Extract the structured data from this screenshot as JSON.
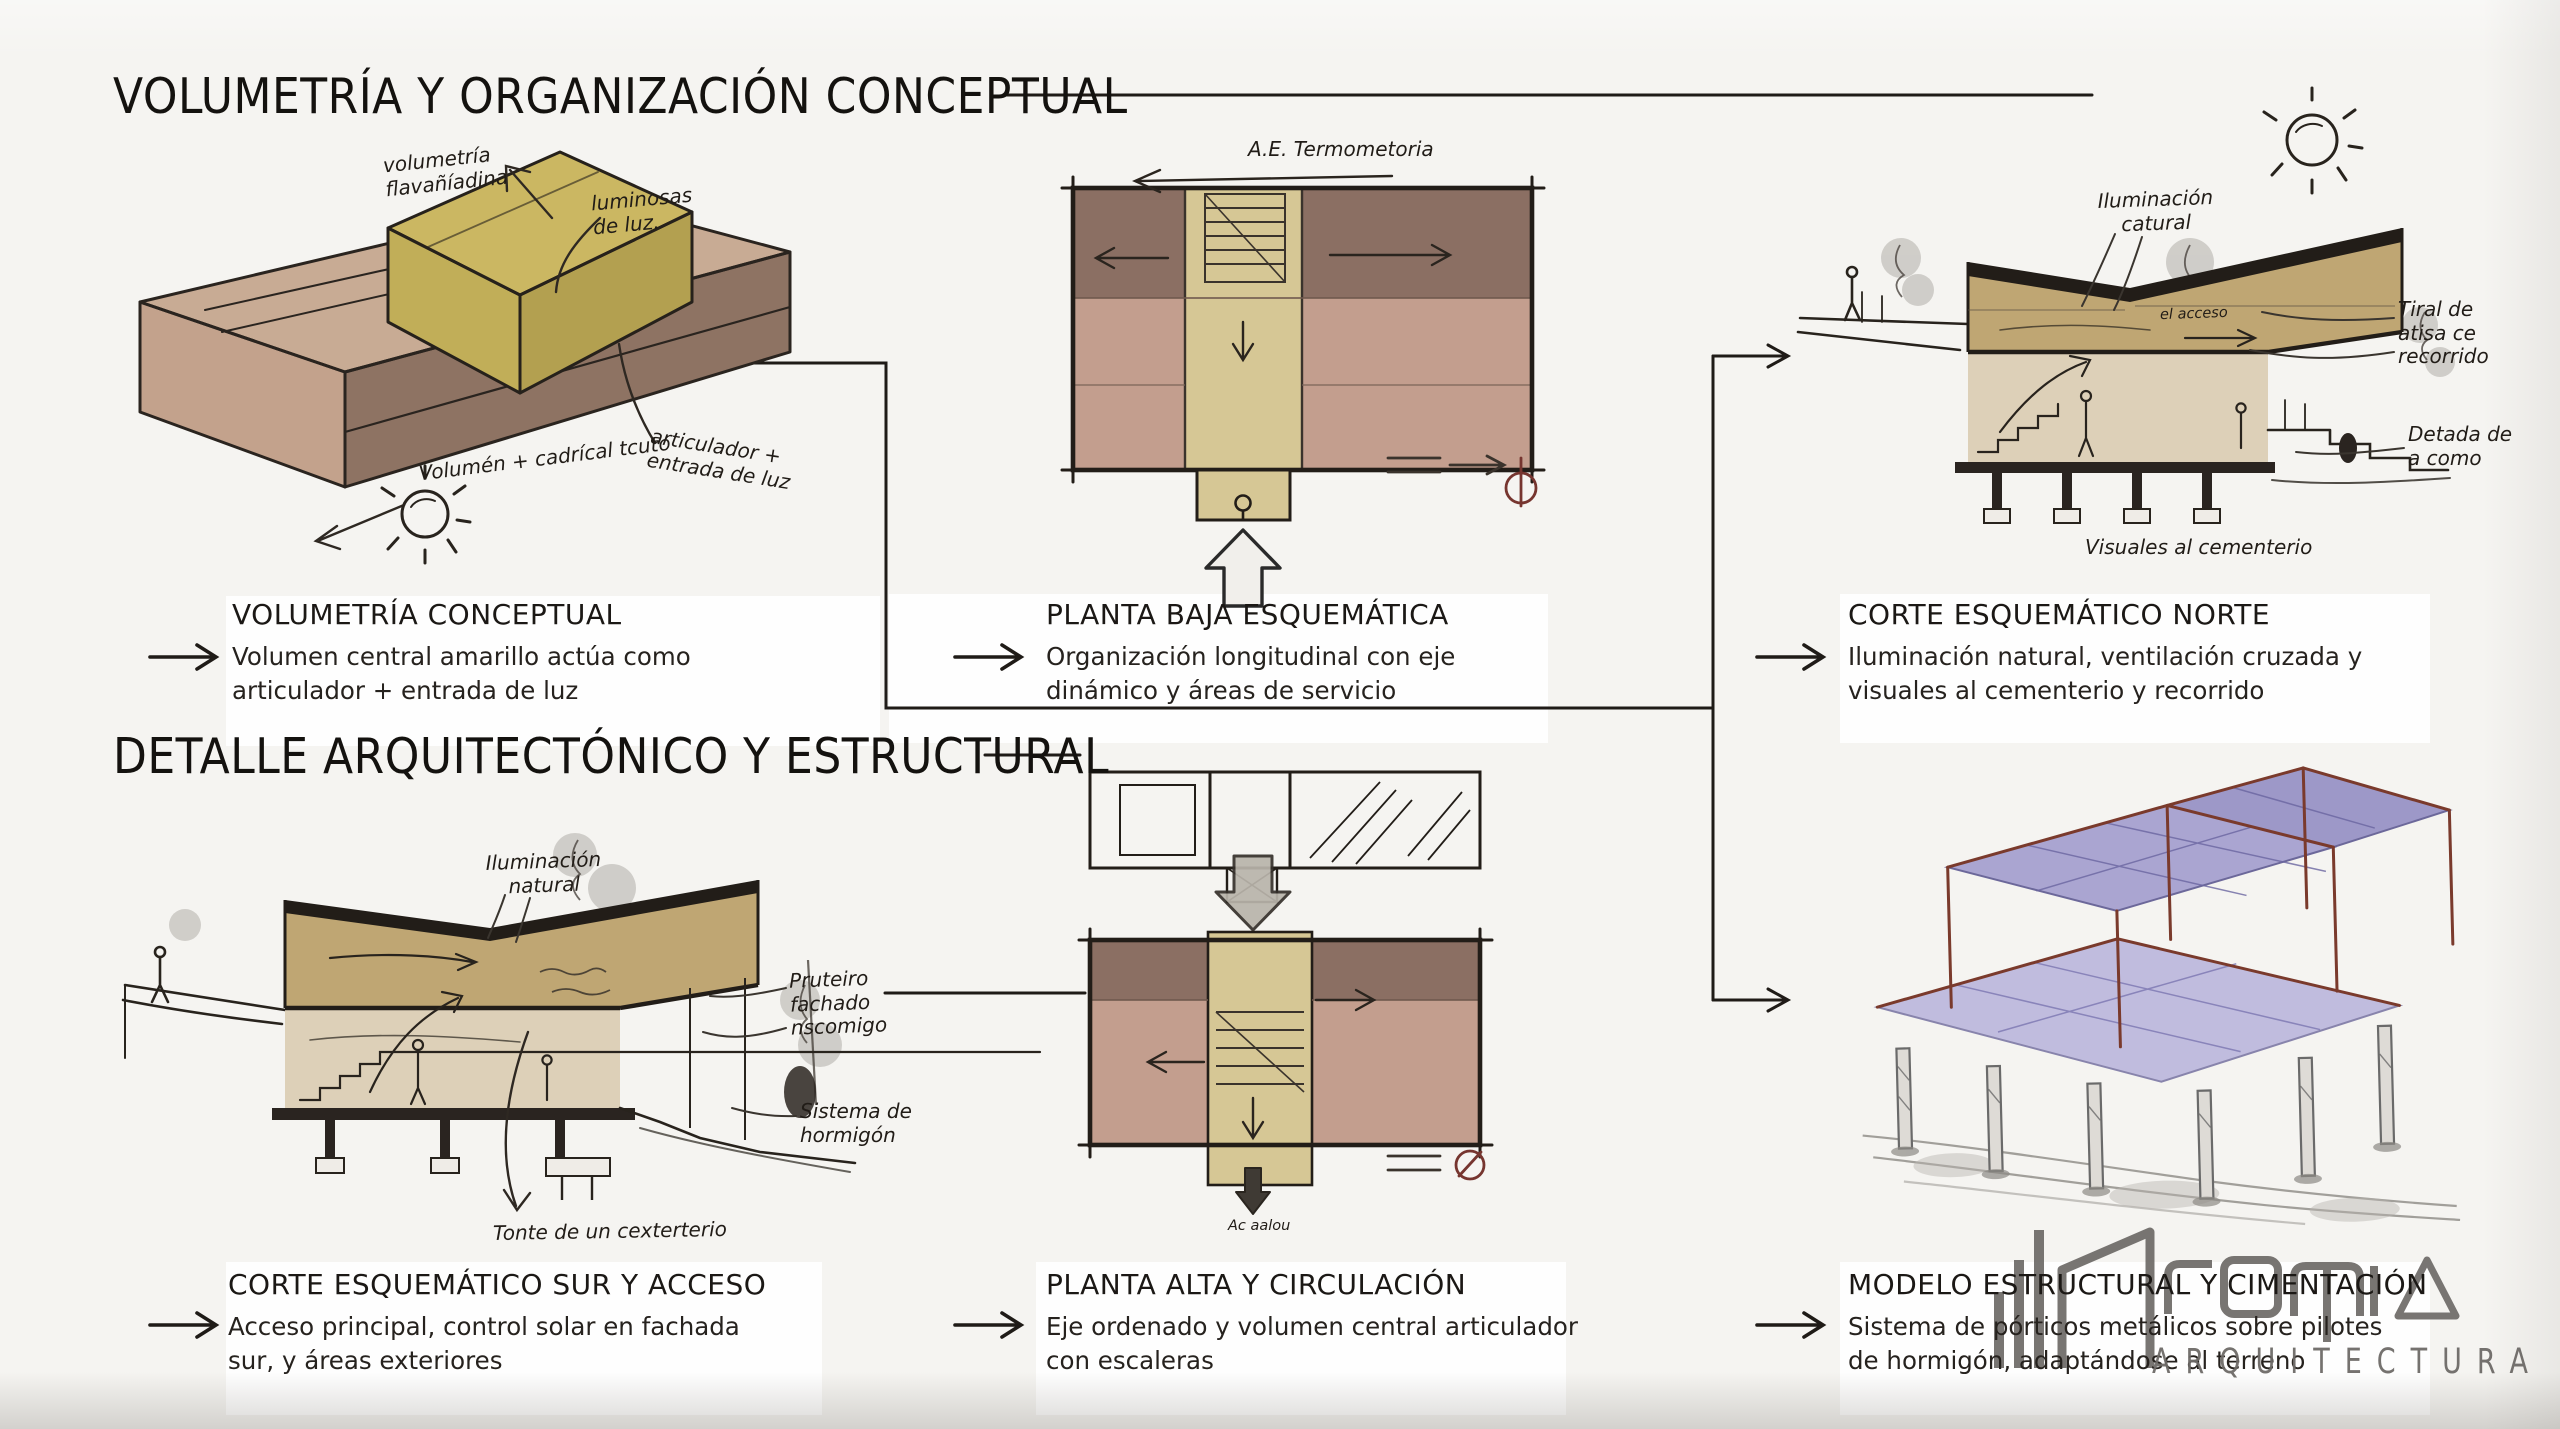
{
  "board": {
    "sections": {
      "top": "VOLUMETRÍA Y ORGANIZACIÓN CONCEPTUAL",
      "bottom": "DETALLE ARQUITECTÓNICO Y ESTRUCTURAL"
    }
  },
  "captions": [
    {
      "title": "VOLUMETRÍA CONCEPTUAL",
      "lines": [
        "Volumen central amarillo actúa como",
        "articulador + entrada de luz"
      ]
    },
    {
      "title": "PLANTA BAJA ESQUEMÁTICA",
      "lines": [
        "Organización longitudinal con eje",
        "dinámico y áreas de servicio"
      ]
    },
    {
      "title": "CORTE ESQUEMÁTICO NORTE",
      "lines": [
        "Iluminación natural, ventilación cruzada y",
        "visuales al cementerio y recorrido"
      ]
    },
    {
      "title": "CORTE ESQUEMÁTICO SUR Y ACCESO",
      "lines": [
        "Acceso principal, control solar en fachada",
        "sur, y áreas exteriores"
      ]
    },
    {
      "title": "PLANTA ALTA Y CIRCULACIÓN",
      "lines": [
        "Eje ordenado y volumen central articulador",
        "con escaleras"
      ]
    },
    {
      "title": "MODELO ESTRUCTURAL Y CIMENTACIÓN",
      "lines": [
        "Sistema de pórticos metálicos sobre pilotes",
        "de hormigón, adaptándose al terreno"
      ]
    }
  ],
  "annotations": {
    "s1_volumetria": "volumetría\nflavañíadina",
    "s1_luz": "luminosas\nde luz.",
    "s1_volumen": "Volumén + cadrícal tcuto",
    "s1_articulador": "articulador +\nentrada de luz",
    "s2_termometoria": "A.E. Termometoria",
    "s3_iluminacion": "Iluminación\ncatural",
    "s3_acceso": "el acceso",
    "s3_tiral": "Tiral de\natisa ce\nrecorrido",
    "s3_detada": "Detada de\na como",
    "s3_visuales": "Visuales al cementerio",
    "s4_iluminacion": "Iluminación\nnatural",
    "s4_fachada": "Pruteiro\nfachado\nnscomigo",
    "s4_sistema": "Sistema de\nhormigón",
    "s4_tonte": "Tonte de un cexterterio",
    "s5_acaalou": "Ac aalou"
  },
  "logo": {
    "wordmark": "ARQUITECTURA"
  },
  "colors": {
    "ink": "#26211c",
    "plan_rose": "#c39e8e",
    "plan_mauve": "#8b6f63",
    "corridor_yellow": "#d6c795",
    "volume_yellow": "#cbb762",
    "band_khaki": "#bfa673",
    "slab_violet": "#9e99cd",
    "beam_red": "#7a3a2c",
    "compass_red": "#76352f",
    "logo_gray": "#6e6b68"
  }
}
